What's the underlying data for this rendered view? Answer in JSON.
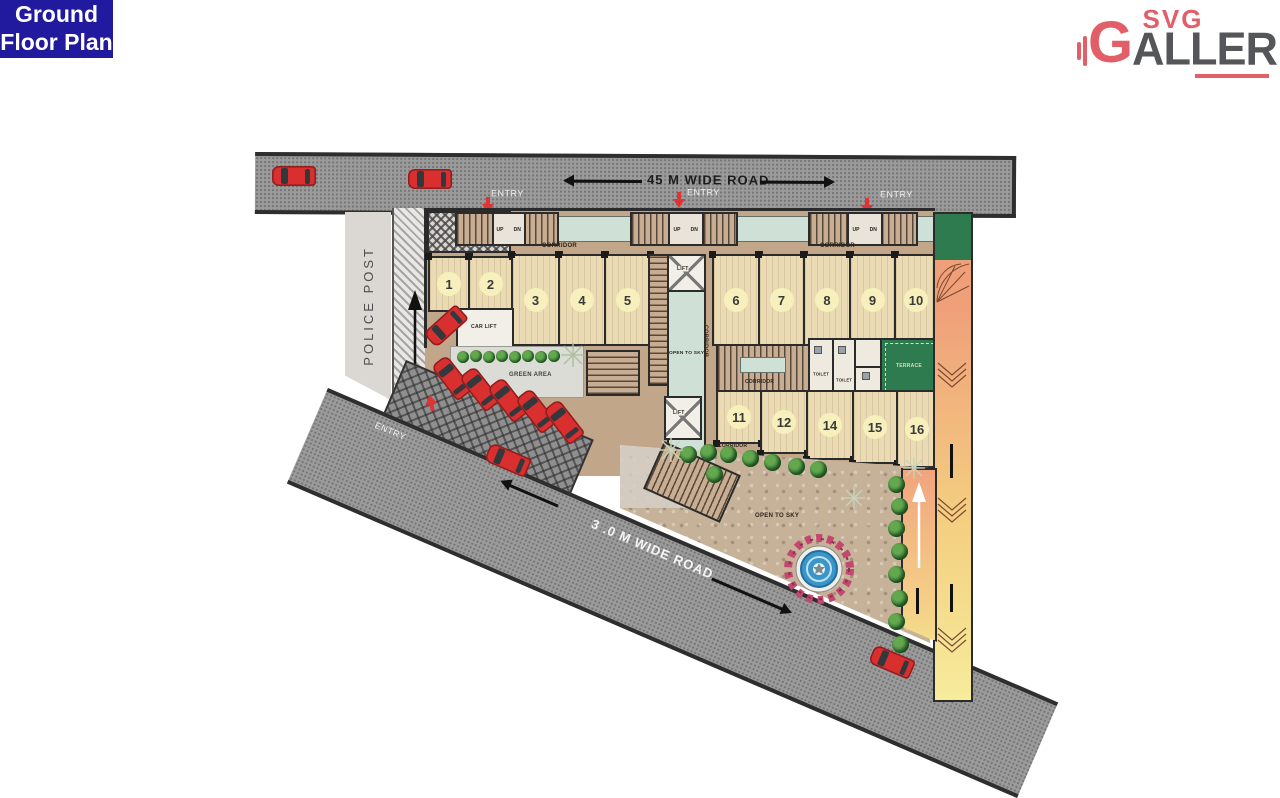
{
  "badge": {
    "line1": "Ground",
    "line2": "Floor Plan"
  },
  "logo": {
    "svg": "SVG",
    "g_initial": "G",
    "name_rest": "ALLERIA"
  },
  "roads": {
    "top_label": "45 M  WIDE ROAD",
    "bottom_label": "3 .0 M  WIDE ROAD",
    "entry": "ENTRY"
  },
  "labels": {
    "police_post": "POLICE POST",
    "corridor": "CORRIDOR",
    "lift": "LIFT",
    "car_lift": "CAR LIFT",
    "open_to_sky": "OPEN TO SKY",
    "green_area": "GREEN AREA",
    "terrace": "TERRACE",
    "toilet": "TOILET",
    "up": "UP",
    "dn": "DN"
  },
  "units": [
    "1",
    "2",
    "3",
    "4",
    "5",
    "6",
    "7",
    "8",
    "9",
    "10",
    "11",
    "12",
    "14",
    "15",
    "16"
  ],
  "colors": {
    "badge_bg": "#211a9e",
    "logo_red": "#e25f68",
    "logo_gray": "#55565a",
    "road_gray": "#9b9b9b",
    "building_tan": "#c2a68a",
    "unit_tan": "#eadbb4",
    "chip_yellow": "#f7f0bd",
    "pale_green": "#cfe1d6",
    "terrace_green": "#2e7b50",
    "ramp_salmon": "#f0a078",
    "ramp_yellow": "#f6ec9c",
    "car_red": "#d92f2f"
  }
}
